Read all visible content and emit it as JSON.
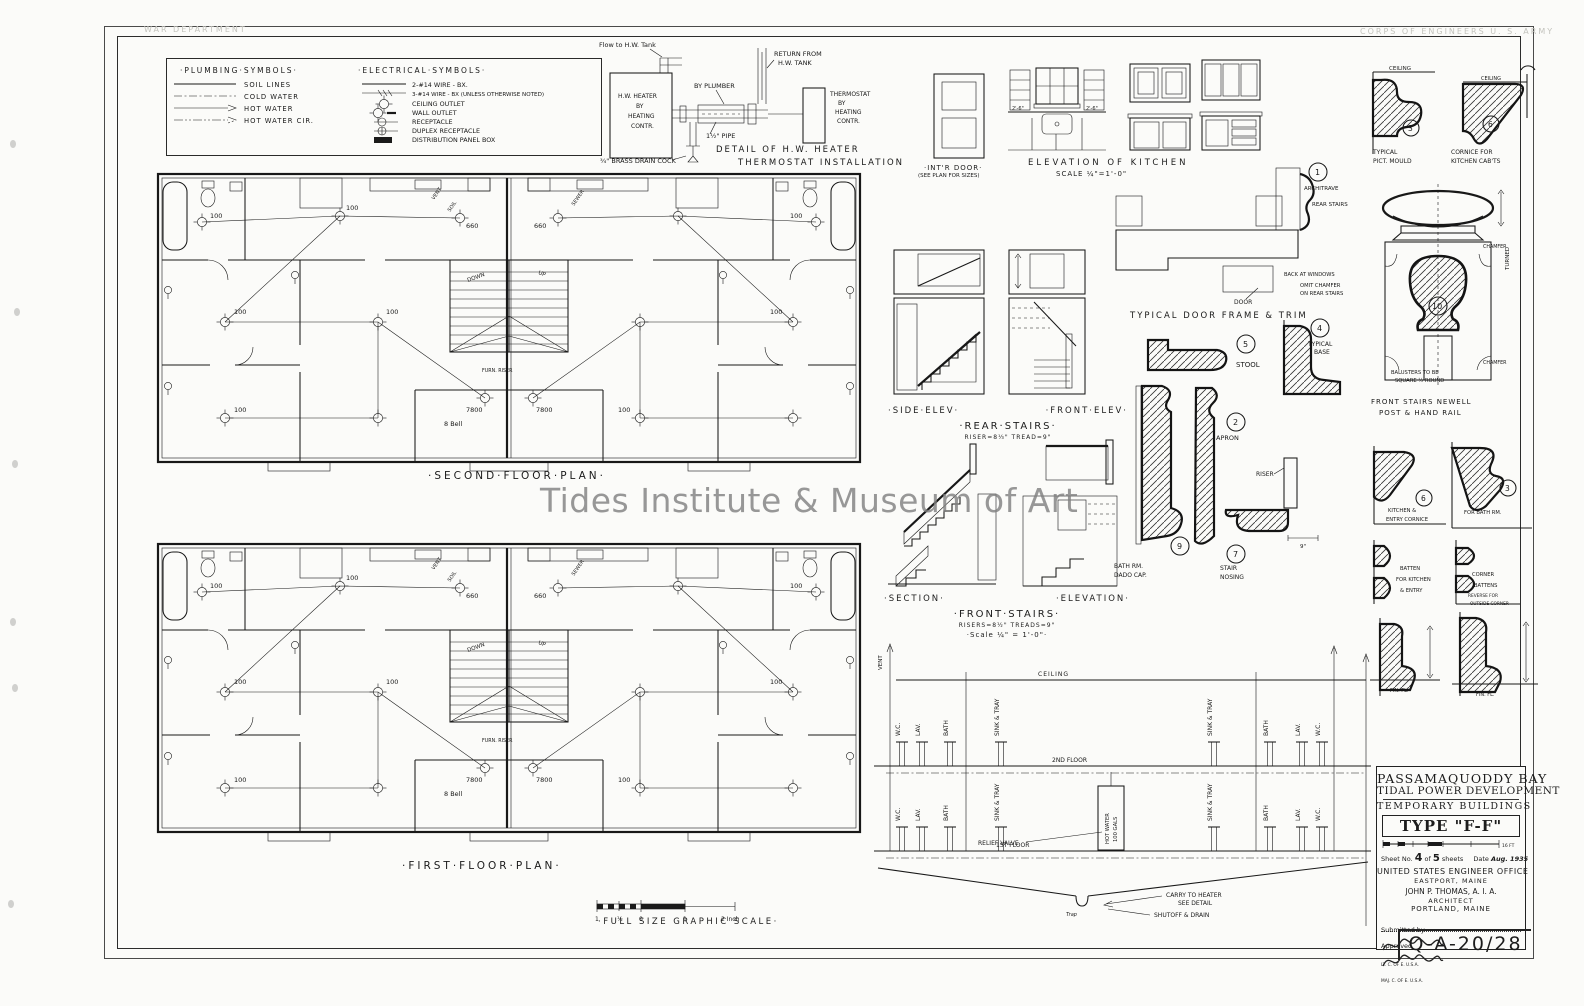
{
  "watermark": "Tides Institute & Museum of Art",
  "stamps": {
    "left": "WAR DEPARTMENT",
    "right": "CORPS OF ENGINEERS   U. S. ARMY"
  },
  "sheet_code": "Q-A-20/28",
  "legend": {
    "plumbing_title": "·PLUMBING·SYMBOLS·",
    "plumbing": [
      "SOIL LINES",
      "COLD WATER",
      "HOT WATER",
      "HOT WATER CIR."
    ],
    "electrical_title": "·ELECTRICAL·SYMBOLS·",
    "electrical": [
      "2-#14 WIRE - BX.",
      "3-#14 WIRE - BX (UNLESS OTHERWISE NOTED)",
      "CEILING OUTLET",
      "WALL OUTLET",
      "RECEPTACLE",
      "DUPLEX RECEPTACLE",
      "DISTRIBUTION PANEL BOX"
    ]
  },
  "heater": {
    "flow": "Flow to H.W. Tank",
    "box": [
      "H.W. HEATER",
      "BY",
      "HEATING",
      "CONTR."
    ],
    "plumber": "BY PLUMBER",
    "return1": "RETURN FROM",
    "return2": "H.W. TANK",
    "thermo": [
      "THERMOSTAT",
      "BY",
      "HEATING",
      "CONTR."
    ],
    "pipe": "1½\" PIPE",
    "drain": "¾\" BRASS DRAIN COCK",
    "cap1": "DETAIL OF H.W. HEATER",
    "cap2": "THERMOSTAT INSTALLATION"
  },
  "kitchen": {
    "door1": "·INT'R DOOR·",
    "door2": "(SEE PLAN FOR SIZES)",
    "cap": "ELEVATION OF KITCHEN",
    "scale": "SCALE ¼\"=1'-0\"",
    "dim": "2'-6\""
  },
  "plans": {
    "second": "·SECOND·FLOOR·PLAN·",
    "first": "·FIRST·FLOOR·PLAN·",
    "labels": {
      "w100": "100",
      "w660": "660",
      "w7800": "7800",
      "bell": "8 Bell",
      "furn": "FURN. RISER",
      "down": "DOWN",
      "up": "UP",
      "vent": "VENT",
      "soil": "SOIL",
      "sewer": "SEWER"
    }
  },
  "scalebar": {
    "cap": "·FULL SIZE GRAPHIC SCALE·",
    "ticks": [
      "1",
      "½",
      "0",
      "1",
      "2 Inch"
    ]
  },
  "stairs": {
    "rear": {
      "l": "·SIDE·ELEV·",
      "r": "·FRONT·ELEV·",
      "cap": "·REAR·STAIRS·",
      "sub": "RISER=8⅓\"  TREAD=9\""
    },
    "front": {
      "l": "·SECTION·",
      "r": "·ELEVATION·",
      "cap": "·FRONT·STAIRS·",
      "sub": "RISERS=8½\"  TREADS=9\"",
      "scale": "·Scale ¼\" = 1'-0\"·"
    }
  },
  "details": {
    "trim_cap": "TYPICAL DOOR FRAME & TRIM",
    "n1": "1",
    "architrave": "ARCHITRAVE",
    "rear_note": "REAR STAIRS",
    "windows_note": "BACK AT WINDOWS",
    "omit1": "OMIT CHAMFER",
    "omit2": "ON REAR STAIRS",
    "door": "DOOR",
    "n5": "5",
    "stool": "STOOL",
    "n4": "4",
    "base1": "TYPICAL",
    "base2": "BASE",
    "n2": "2",
    "apron": "APRON",
    "n9": "9",
    "dado1": "BATH RM.",
    "dado2": "DADO CAP.",
    "n7": "7",
    "nosing1": "STAIR",
    "nosing2": "NOSING",
    "riser": "RISER",
    "nine": "9\"",
    "n3": "3",
    "pict1": "TYPICAL",
    "pict2": "PICT. MOULD",
    "ceiling": "CEILING",
    "n6": "6",
    "corn1": "CORNICE FOR",
    "corn2": "KITCHEN CAB'TS",
    "n10": "10",
    "newel1": "FRONT STAIRS NEWELL",
    "newel2": "POST & HAND RAIL",
    "turned": "TURNED",
    "chamfer": "CHAMFER",
    "balusters1": "BALUSTERS TO BE",
    "balusters2": "SQUARE ½ ROUND",
    "entry1": "KITCHEN &",
    "entry2": "ENTRY CORNICE",
    "bathrm": "FOR BATH RM.",
    "batten1": "BATTEN",
    "batten2": "FOR KITCHEN",
    "batten3": "& ENTRY",
    "corner1": "CORNER",
    "corner2": "BATTENS",
    "corner3": "REVERSE FOR",
    "corner4": "OUTSIDE CORNER",
    "finfl": "FIN. FL."
  },
  "riser_diag": {
    "vent": "VENT",
    "ceiling": "CEILING",
    "fl2": "2ND FLOOR",
    "fl1": "1ST FLOOR",
    "wc": "W.C.",
    "lav": "LAV.",
    "bath": "BATH",
    "sink": "SINK & TRAY",
    "tank1": "HOT WATER",
    "tank2": "100 GALS",
    "relief": "RELIEF VALVE",
    "carry1": "CARRY TO HEATER",
    "carry2": "SEE DETAIL",
    "shutoff": "SHUTOFF & DRAIN",
    "trap": "Trap"
  },
  "titleblock": {
    "p1": "PASSAMAQUODDY BAY",
    "p2": "TIDAL POWER DEVELOPMENT",
    "sub": "TEMPORARY BUILDINGS",
    "type": "TYPE \"F-F\"",
    "sheet_a": "Sheet No.",
    "sheet_n": "4",
    "sheet_b": "of",
    "sheet_t": "5",
    "sheet_c": "sheets",
    "date_a": "Date",
    "date": "Aug. 1935",
    "office1": "UNITED STATES ENGINEER OFFICE",
    "office2": "EASTPORT, MAINE",
    "arch1": "JOHN P. THOMAS,   A. I. A.",
    "arch2": "ARCHITECT",
    "arch3": "PORTLAND,   MAINE",
    "sub_by": "Submitted by",
    "sub_t": "LT. C. OF E. U.S.A.",
    "app": "Approved",
    "app_t": "MAJ. C. OF E. U.S.A.",
    "scale_end": "16 FT"
  }
}
